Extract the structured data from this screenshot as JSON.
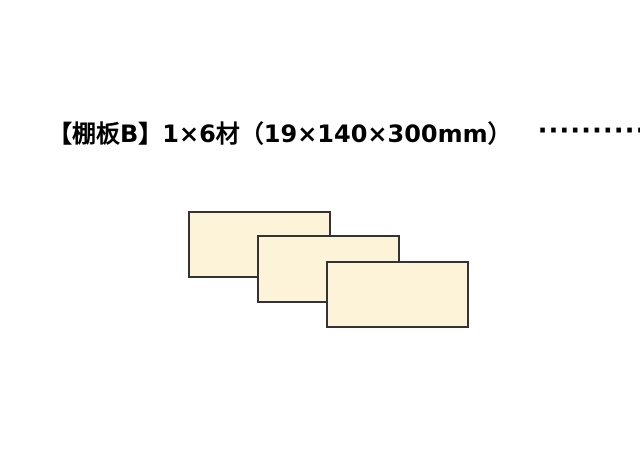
{
  "header": {
    "label": "【棚板B】1×6材（19×140×300mm）",
    "dots": "············",
    "count": "3枚"
  },
  "diagram": {
    "board_count": 3,
    "board_fill": "#FCF3D8",
    "board_border": "#333333",
    "boards": [
      {
        "x": 188,
        "y": 211,
        "w": 143,
        "h": 67
      },
      {
        "x": 257,
        "y": 235,
        "w": 143,
        "h": 68
      },
      {
        "x": 326,
        "y": 261,
        "w": 143,
        "h": 67
      }
    ]
  },
  "colors": {
    "background": "#FFFFFF",
    "text": "#000000"
  }
}
